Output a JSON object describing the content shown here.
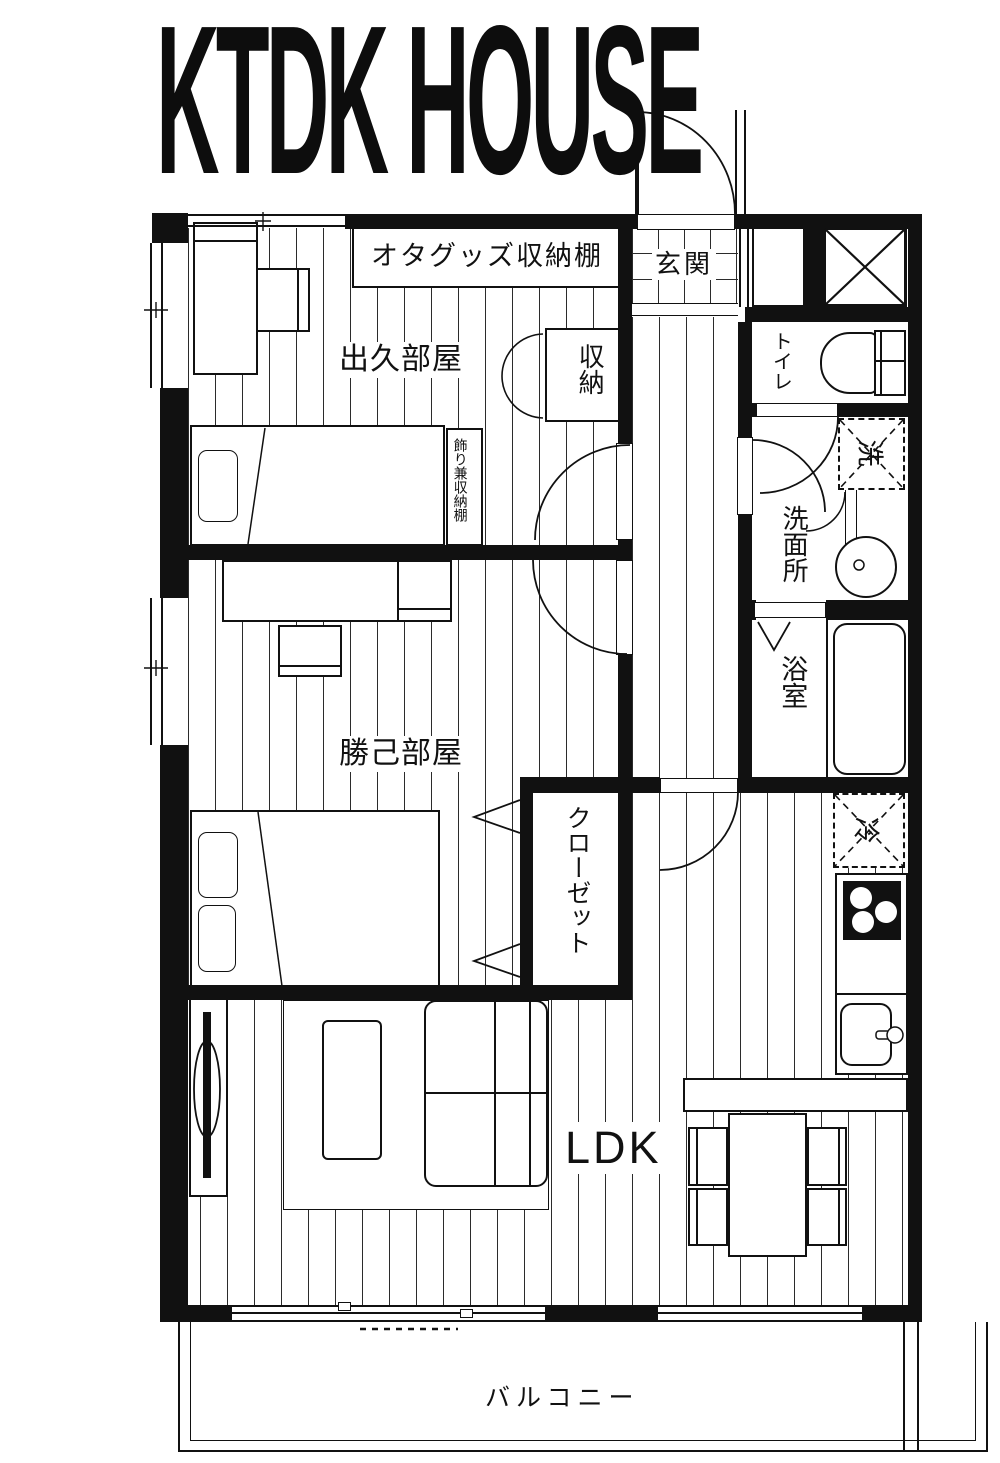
{
  "title": "KTDK HOUSE",
  "rooms": {
    "genkan": {
      "label": "玄関"
    },
    "deku_room": {
      "label": "出久部屋"
    },
    "katsuki_room": {
      "label": "勝己部屋"
    },
    "ldk": {
      "label": "LDK"
    },
    "toilet": {
      "label": "トイレ"
    },
    "washroom": {
      "label": "洗面所"
    },
    "bathroom": {
      "label": "浴室"
    },
    "storage": {
      "label": "収納"
    },
    "closet": {
      "label": "クローゼット"
    },
    "balcony": {
      "label": "バルコニー"
    }
  },
  "fixtures": {
    "ota_shelf": {
      "label": "オタグッズ収納棚"
    },
    "display_shelf": {
      "label": "飾り兼収納棚"
    },
    "washing_machine": {
      "label": "洗"
    },
    "refrigerator": {
      "label": "冷"
    }
  },
  "colors": {
    "ink": "#111111",
    "paper": "#ffffff"
  }
}
